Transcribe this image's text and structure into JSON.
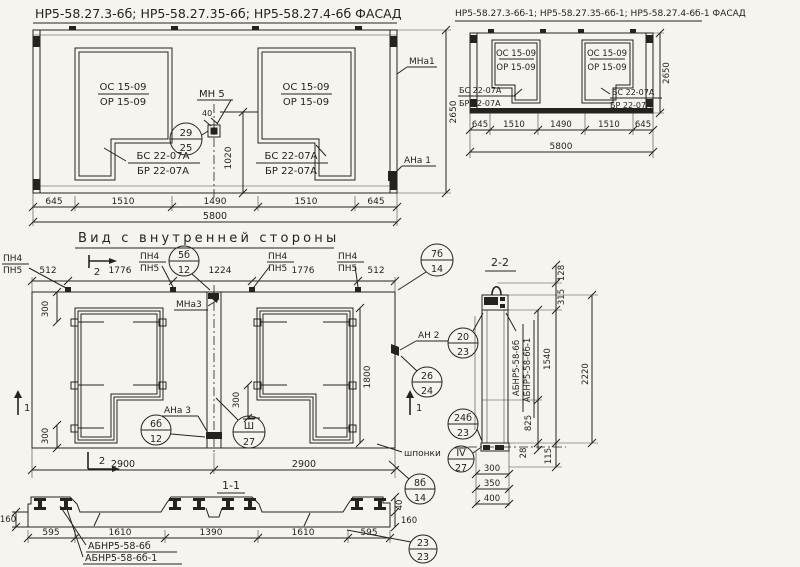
{
  "common": {
    "os": "ОС 15-09",
    "or": "ОР 15-09",
    "bs": "БС 22-07А",
    "br": "БР 22-07А",
    "pn4": "ПН4",
    "pn5": "ПН5",
    "abnr": "АБНР5-58-6б",
    "abnr1": "АБНР5-58-6б-1"
  },
  "facade_left": {
    "title": "НР5-58.27.3-6б; НР5-58.27.35-6б; НР5-58.27.4-6б ФАСАД",
    "mn5": "МН 5",
    "dim_40": "40",
    "callout_29_25": {
      "top": "29",
      "bottom": "25"
    },
    "dim_1020": "1020",
    "mna1": "МНа1",
    "ana1": "АНа 1",
    "dim_height": "2650",
    "dims_bottom": [
      "645",
      "1510",
      "1490",
      "1510",
      "645"
    ],
    "dim_total": "5800"
  },
  "facade_right": {
    "title": "НР5-58.27.3-6б-1; НР5-58.27.35-6б-1; НР5-58.27.4-6б-1 ФАСАД",
    "dims_bottom": [
      "645",
      "1510",
      "1490",
      "1510",
      "645"
    ],
    "dim_total": "5800",
    "dim_height": "2650"
  },
  "inner_view": {
    "title": "Вид с внутренней стороны",
    "dims_top": [
      "512",
      "1776",
      "1224",
      "1776",
      "512"
    ],
    "marker_2": "2",
    "marker_1": "1",
    "callout_5b_12": {
      "top": "5б",
      "bottom": "12"
    },
    "callout_7b_14": {
      "top": "7б",
      "bottom": "14"
    },
    "mna3": "МНа3",
    "ana3": "АНа 3",
    "an2": "АН 2",
    "callout_26_24": {
      "top": "26",
      "bottom": "24"
    },
    "callout_6b_12": {
      "top": "6б",
      "bottom": "12"
    },
    "callout_sh_27": {
      "top": "Ш",
      "bottom": "27"
    },
    "dim_300": "300",
    "dim_1800": "1800",
    "dims_bottom": [
      "2900",
      "2900"
    ],
    "shponki": "шпонки",
    "callout_8b_14": {
      "top": "8б",
      "bottom": "14"
    }
  },
  "section_1_1": {
    "title": "1-1",
    "dim_160": "160",
    "dim_40": "40",
    "dims_bottom": [
      "595",
      "1610",
      "1390",
      "1610",
      "595"
    ],
    "callout_23_23": {
      "top": "23",
      "bottom": "23"
    }
  },
  "section_2_2": {
    "title": "2-2",
    "dim_128": "128",
    "dim_315": "315",
    "dim_1540": "1540",
    "dim_2220": "2220",
    "dim_825": "825",
    "dim_28": "28",
    "dim_115": "115",
    "dims_bottom": [
      "300",
      "350",
      "400"
    ],
    "callout_20_23": {
      "top": "20",
      "bottom": "23"
    },
    "callout_24b_23": {
      "top": "24б",
      "bottom": "23"
    },
    "callout_iv_27": {
      "top": "IV",
      "bottom": "27"
    }
  }
}
